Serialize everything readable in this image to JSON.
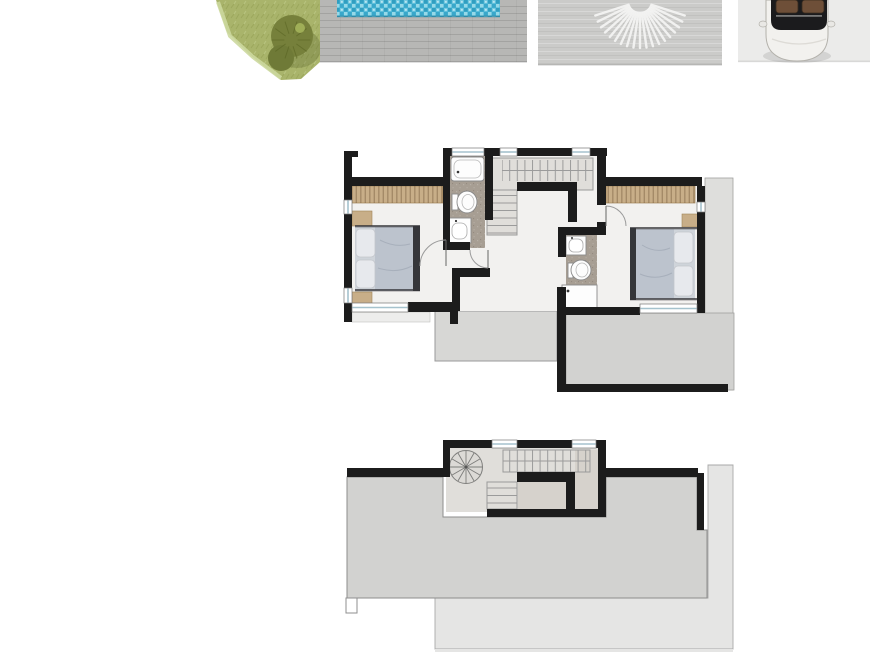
{
  "image": {
    "width": 870,
    "height": 652,
    "background": "#ffffff"
  },
  "colors": {
    "wall": "#1c1c1c",
    "outline": "#8f8f8f",
    "floor": "#f2f1ef",
    "bathroom_floor": "#a79e93",
    "wardrobe": "#c8ae88",
    "terrace_small": "#d7d7d5",
    "terrace_large": "#d2d2d0",
    "side_terrace": "#dededc",
    "roof": "#d2d2d0",
    "apron": "#e5e5e4",
    "landing": "#d6d2cc",
    "stair_area": "#e0deda",
    "lawn": "#a9b46b",
    "lawn_edge": "#ccd89e",
    "tree": "#76803b",
    "tree_dark": "#6f7a37",
    "pool_water": "#45b3d3",
    "pool_edge": "#2d7e99",
    "deck": "#b7b7b5",
    "patio": "#cbcbc9",
    "sunburst": "#f4f4f3",
    "driveway": "#ebebea",
    "car_body": "#f2f1ee",
    "car_glass": "#1b1b1d",
    "car_seats": "#6e4f38",
    "bed_mattress": "#cfd4da",
    "bed_duvet": "#bcc3cd",
    "bed_frame": "#35363a",
    "pillow": "#e7e9ed",
    "window_glass": "#a5c2cd"
  },
  "site": {
    "elements": [
      "lawn",
      "tree",
      "swimming-pool",
      "timber-deck",
      "paved-patio-sunburst",
      "driveway",
      "car-top-view"
    ]
  },
  "upper_floor_plan": {
    "rooms": [
      "bedroom-1",
      "bathroom-1",
      "staircase",
      "hallway",
      "bathroom-2",
      "bedroom-2",
      "terrace-small",
      "terrace-large",
      "side-terrace"
    ],
    "fixtures": [
      "double-bed-1",
      "wardrobe-1",
      "nightstands",
      "bathtub",
      "toilet-1",
      "washbasin-1",
      "double-bed-2",
      "wardrobe-2",
      "washbasin-2",
      "toilet-2",
      "shower"
    ]
  },
  "roof_plan": {
    "elements": [
      "stair-enclosure",
      "spiral-staircase",
      "staircase",
      "roof-deck",
      "lower-roof-apron",
      "roof-step"
    ]
  }
}
